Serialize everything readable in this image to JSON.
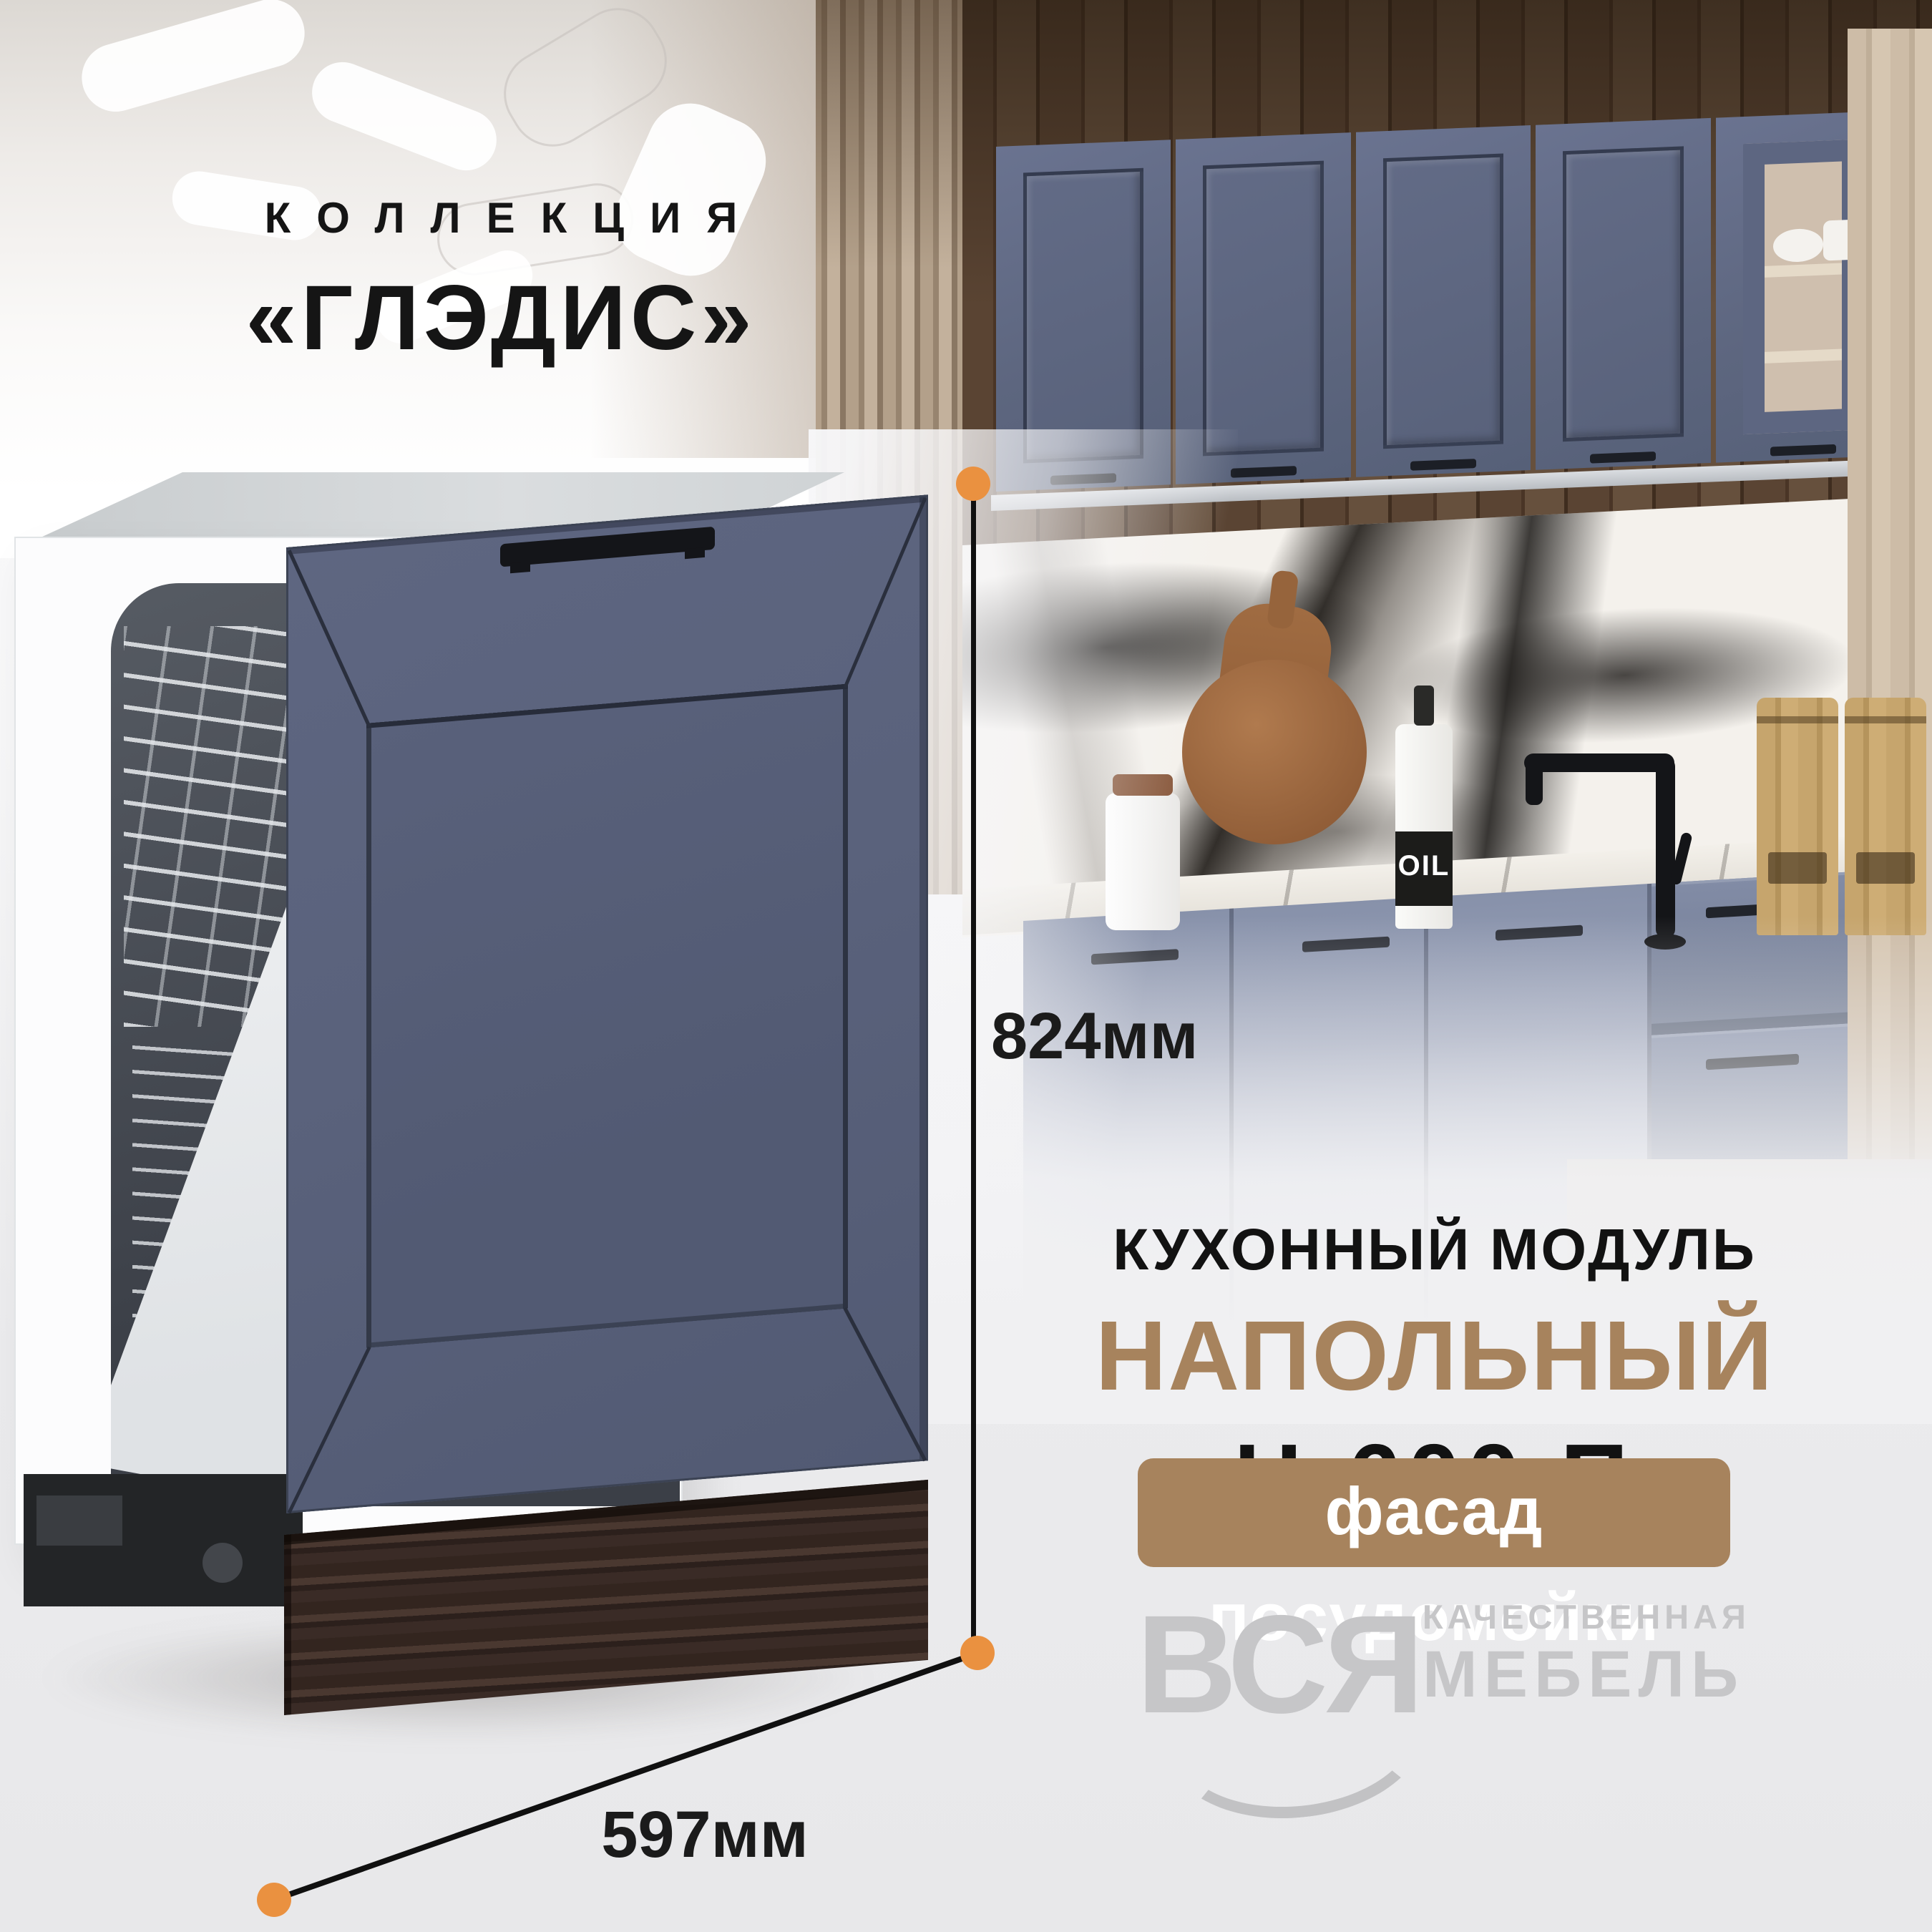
{
  "collection": {
    "label": "КОЛЛЕКЦИЯ",
    "name": "«ГЛЭДИС»"
  },
  "dimensions": {
    "height": "824мм",
    "width": "597мм"
  },
  "product": {
    "category": "КУХОННЫЙ МОДУЛЬ",
    "type": "НАПОЛЬНЫЙ",
    "model": "Н-600 П",
    "badge": "фасад посудомойки"
  },
  "brand": {
    "name": "ВСЯ",
    "tagline_line1": "КАЧЕСТВЕННАЯ",
    "tagline_line2": "МЕБЕЛЬ"
  },
  "props": {
    "oil_bottle_label": "OIL"
  },
  "colors": {
    "accent_orange": "#ea9140",
    "accent_brown": "#a7835d",
    "facade_blue": "#5a627c",
    "logo_gray": "#c6c6c8",
    "dimension_text": "#1b1b1b"
  }
}
